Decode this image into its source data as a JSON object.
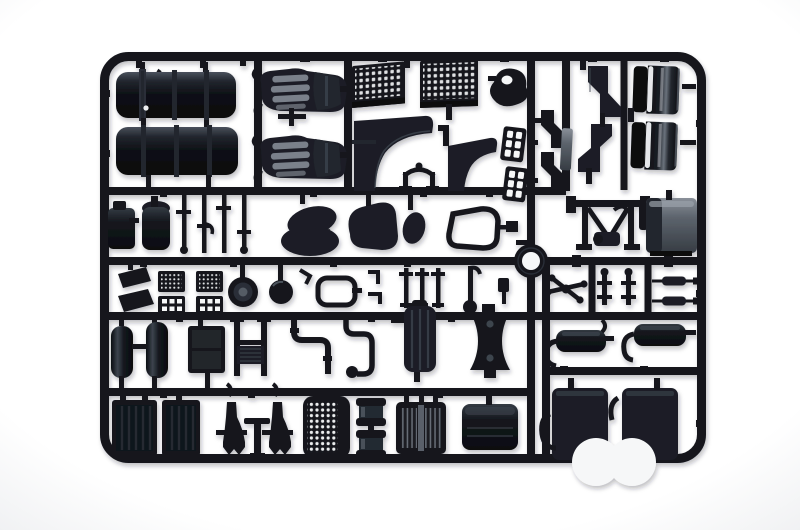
{
  "scene": {
    "description": "Photograph of a black injection-moulded plastic model kit sprue (parts runner) for a truck model, laid on a plain white background. The rectangular runner frame with rounded corners holds dozens of unpainted parts: two cylindrical fuel tanks, two cab seats with grey cushion ribs, perforated radiator grilles, cab fender panels, entry steps, mudguard side panels, glossy wind deflectors, small tanks and linkage rods, a seat cushion, engine cover, cab-back outline ring part, chassis crossmember, a grey battery box, mesh pedal plates, hub discs, air reservoirs, pipework, an AdBlue tank, engine mounts, mufflers, intercooler radiators, engine pedestals, a perforated basket, twin wheel rims, a radiator core, a storage box and two rear wheel-arch fenders.",
    "material": "dark blue-black polystyrene, glossy highlights",
    "background": "plain white studio background, soft shadow under runner"
  },
  "colors": {
    "bg_center": "#ffffff",
    "bg_edge": "#eff0f2",
    "plastic": "#14171d",
    "plastic_soft": "#1b1f26",
    "plastic_deep": "#0a0c10",
    "highlight": "#8b929c",
    "edge_sheen": "#434a54",
    "rib": "#2a2f37",
    "gray_part": "#5d646d",
    "gloss": "#f2f3f5",
    "hole": "#f6f7f8",
    "shadow": "#20242c"
  },
  "sprue": {
    "frame": {
      "rows": 5,
      "full_height_runners": 2,
      "corner_style": "rounded"
    },
    "parts": [
      {
        "id": "fuel-tanks",
        "label": "cylindrical fuel tanks with straps"
      },
      {
        "id": "cab-seats",
        "label": "cab seats with grey cushion ribs"
      },
      {
        "id": "radiator-grilles",
        "label": "perforated radiator grille panels"
      },
      {
        "id": "hub-housing",
        "label": "wheel hub housing"
      },
      {
        "id": "cab-fenders",
        "label": "curved cab fender panels"
      },
      {
        "id": "entry-steps",
        "label": "perforated entry step plates"
      },
      {
        "id": "step-brackets",
        "label": "Z-shaped step brackets"
      },
      {
        "id": "mudguard-panels",
        "label": "mudguard side panels"
      },
      {
        "id": "wind-deflectors",
        "label": "glossy wind deflector panels"
      },
      {
        "id": "small-tanks",
        "label": "small reservoir tanks"
      },
      {
        "id": "linkage-rods",
        "label": "linkage rods"
      },
      {
        "id": "seat-cushion",
        "label": "seat cushion"
      },
      {
        "id": "engine-cover",
        "label": "engine cover hump"
      },
      {
        "id": "mirror-housing",
        "label": "mirror housing"
      },
      {
        "id": "cab-back-outline",
        "label": "cab back window outline"
      },
      {
        "id": "alignment-ring",
        "label": "round ring part on runner hub"
      },
      {
        "id": "chassis-crossmember",
        "label": "chassis crossmember assembly"
      },
      {
        "id": "battery-box",
        "label": "grey battery box"
      },
      {
        "id": "intake-wedges",
        "label": "air intake wedges"
      },
      {
        "id": "pedal-plates",
        "label": "mesh pedal plates"
      },
      {
        "id": "hub-discs",
        "label": "round hub discs"
      },
      {
        "id": "gasket-outline",
        "label": "open gasket outline"
      },
      {
        "id": "valve-stems",
        "label": "valve stems and posts"
      },
      {
        "id": "mirror-arms",
        "label": "mirror arm cross"
      },
      {
        "id": "piston-rods",
        "label": "piston rods with sleeves"
      },
      {
        "id": "air-reservoirs",
        "label": "air reservoir cylinders"
      },
      {
        "id": "oil-cooler",
        "label": "ribbed oil cooler box"
      },
      {
        "id": "pipe-ladder",
        "label": "pipe ladder with fins"
      },
      {
        "id": "exhaust-pipes",
        "label": "bent exhaust pipes"
      },
      {
        "id": "adblue-tank",
        "label": "tall AdBlue tank"
      },
      {
        "id": "engine-mount",
        "label": "waisted engine mount block"
      },
      {
        "id": "mufflers",
        "label": "muffler boxes with S-pipes"
      },
      {
        "id": "intercoolers",
        "label": "ribbed intercooler boxes"
      },
      {
        "id": "engine-pedestals",
        "label": "trumpet engine pedestals"
      },
      {
        "id": "tee-lever",
        "label": "T-shaped lever"
      },
      {
        "id": "perforated-basket",
        "label": "perforated stowage basket"
      },
      {
        "id": "wheel-rims",
        "label": "twin wheel rims"
      },
      {
        "id": "radiator-core",
        "label": "slatted radiator core"
      },
      {
        "id": "storage-box",
        "label": "smooth storage box"
      },
      {
        "id": "rear-fenders",
        "label": "rear fenders with wheel arches"
      }
    ]
  }
}
